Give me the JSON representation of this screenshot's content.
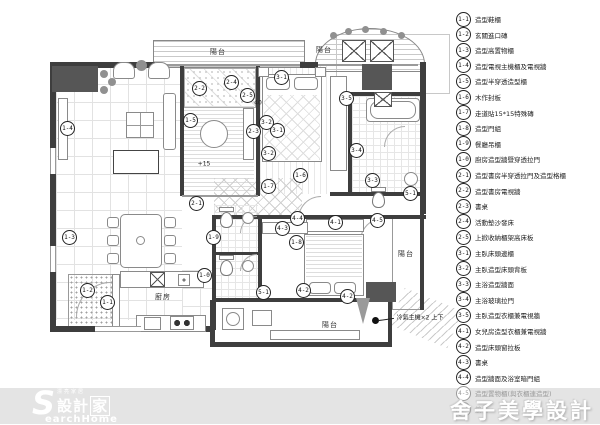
{
  "colors": {
    "wall": "#3e3e3e",
    "band": "#e4e4e4",
    "dark_block": "#565656",
    "marker_border": "#222222"
  },
  "footer": {
    "brand_small": "漂亮家居",
    "brand_cn": "設計",
    "brand_home": "家",
    "brand_s": "S",
    "brand_en": "earchHome",
    "designer": "舍子美學設計"
  },
  "legend": {
    "items": [
      {
        "id": "1-1",
        "label": "造型鞋櫃"
      },
      {
        "id": "1-2",
        "label": "玄關進口磚"
      },
      {
        "id": "1-3",
        "label": "造型高置物櫃"
      },
      {
        "id": "1-4",
        "label": "造型電視主機櫃及電視牆"
      },
      {
        "id": "1-5",
        "label": "造型半穿透造型櫃"
      },
      {
        "id": "1-6",
        "label": "木作封板"
      },
      {
        "id": "1-7",
        "label": "走道貼15*15特殊磚"
      },
      {
        "id": "1-8",
        "label": "造型門組"
      },
      {
        "id": "1-9",
        "label": "餐廳吊櫃"
      },
      {
        "id": "1-0",
        "label": "廚房造型牆暨穿透拉門"
      },
      {
        "id": "2-1",
        "label": "造型書房半穿透拉門及造型格櫃"
      },
      {
        "id": "2-2",
        "label": "造型書房電視牆"
      },
      {
        "id": "2-3",
        "label": "書桌"
      },
      {
        "id": "2-4",
        "label": "活動墊沙發床"
      },
      {
        "id": "2-5",
        "label": "上掀收納櫃架高床板"
      },
      {
        "id": "3-1",
        "label": "主臥床頭邊櫃"
      },
      {
        "id": "3-2",
        "label": "主臥造型床頭背板"
      },
      {
        "id": "3-3",
        "label": "主浴造型牆面"
      },
      {
        "id": "3-4",
        "label": "主浴玻璃拉門"
      },
      {
        "id": "3-5",
        "label": "主臥造型衣櫃兼電視牆"
      },
      {
        "id": "4-1",
        "label": "女兒房造型衣櫃兼電視牆"
      },
      {
        "id": "4-2",
        "label": "造型床頭窗拉板"
      },
      {
        "id": "4-3",
        "label": "書桌"
      },
      {
        "id": "4-4",
        "label": "造型牆面及浴室暗門組"
      },
      {
        "id": "4-5",
        "label": "造型置物櫃(與衣櫃連造型)",
        "muted": true
      },
      {
        "id": "5-1",
        "label": "鏡櫃",
        "muted": true
      }
    ]
  },
  "plan": {
    "markers": [
      {
        "id": "1-1",
        "x": 107,
        "y": 302
      },
      {
        "id": "1-2",
        "x": 87,
        "y": 290
      },
      {
        "id": "1-3",
        "x": 69,
        "y": 237
      },
      {
        "id": "1-4",
        "x": 67,
        "y": 128
      },
      {
        "id": "1-5",
        "x": 190,
        "y": 120
      },
      {
        "id": "1-6",
        "x": 300,
        "y": 175
      },
      {
        "id": "1-7",
        "x": 268,
        "y": 186
      },
      {
        "id": "1-8",
        "x": 296,
        "y": 242
      },
      {
        "id": "1-9",
        "x": 213,
        "y": 237
      },
      {
        "id": "1-0",
        "x": 204,
        "y": 275
      },
      {
        "id": "2-1",
        "x": 196,
        "y": 203
      },
      {
        "id": "2-2",
        "x": 199,
        "y": 88
      },
      {
        "id": "2-3",
        "x": 253,
        "y": 131
      },
      {
        "id": "2-4",
        "x": 231,
        "y": 82
      },
      {
        "id": "2-5",
        "x": 247,
        "y": 95
      },
      {
        "id": "3-1",
        "x": 281,
        "y": 77
      },
      {
        "id": "3-1",
        "x": 277,
        "y": 130
      },
      {
        "id": "3-2",
        "x": 266,
        "y": 122
      },
      {
        "id": "3-2",
        "x": 268,
        "y": 153
      },
      {
        "id": "3-3",
        "x": 372,
        "y": 180
      },
      {
        "id": "3-4",
        "x": 356,
        "y": 150
      },
      {
        "id": "3-5",
        "x": 346,
        "y": 98
      },
      {
        "id": "4-1",
        "x": 335,
        "y": 222
      },
      {
        "id": "4-2",
        "x": 303,
        "y": 290
      },
      {
        "id": "4-2",
        "x": 347,
        "y": 296
      },
      {
        "id": "4-3",
        "x": 282,
        "y": 228
      },
      {
        "id": "4-4",
        "x": 297,
        "y": 218
      },
      {
        "id": "4-5",
        "x": 377,
        "y": 220
      },
      {
        "id": "5-1",
        "x": 410,
        "y": 193
      },
      {
        "id": "5-1",
        "x": 263,
        "y": 292
      }
    ],
    "room_labels": [
      {
        "text": "陽台",
        "x": 218,
        "y": 52
      },
      {
        "text": "陽台",
        "x": 324,
        "y": 50
      },
      {
        "text": "陽台",
        "x": 406,
        "y": 254
      },
      {
        "text": "陽台",
        "x": 330,
        "y": 325
      },
      {
        "text": "廚房",
        "x": 163,
        "y": 297
      }
    ],
    "notes": [
      {
        "text": "+15",
        "x": 204,
        "y": 164
      },
      {
        "text": "40",
        "x": 258,
        "y": 103
      },
      {
        "text": "冷氣主機×2 上下",
        "x": 420,
        "y": 317
      }
    ]
  }
}
